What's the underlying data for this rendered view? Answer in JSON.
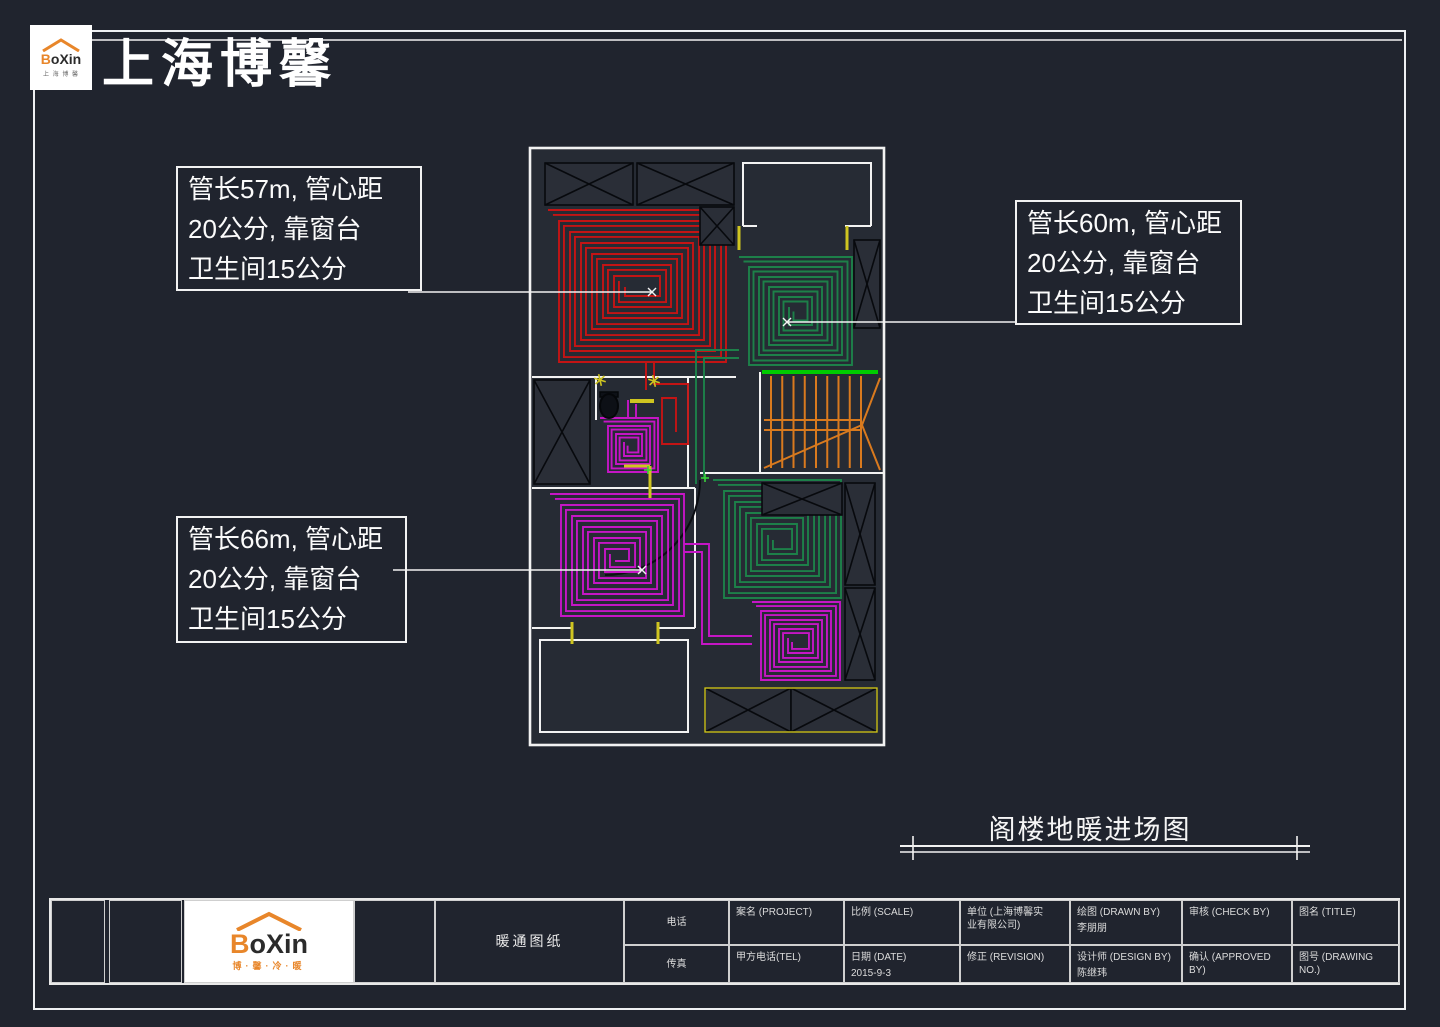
{
  "header": {
    "brand_title": "上海博馨",
    "logo_word": "Boxin",
    "logo_sub_top": "上 海 博 馨"
  },
  "annotations": [
    {
      "text": "管长57m, 管心距\n20公分, 靠窗台\n卫生间15公分"
    },
    {
      "text": "管长60m, 管心距\n20公分, 靠窗台\n卫生间15公分"
    },
    {
      "text": "管长66m, 管心距\n20公分, 靠窗台\n卫生间15公分"
    }
  ],
  "drawing_title": "阁楼地暖进场图",
  "title_block": {
    "category": "暖通图纸",
    "logo_word": "Boxin",
    "logo_sub": "博·馨·冷·暖",
    "phone_label": "电话",
    "fax_label": "传真",
    "project_label": "案名 (PROJECT)",
    "client_tel_label": "甲方电话(TEL)",
    "scale_label": "比例 (SCALE)",
    "date_label": "日期 (DATE)",
    "date_value": "2015-9-3",
    "company_label": "单位 (上海博馨实\n业有限公司)",
    "revision_label": "修正 (REVISION)",
    "drawn_by_label": "绘图 (DRAWN BY)",
    "drawn_by_value": "李朋朋",
    "designer_label": "设计师 (DESIGN BY)",
    "designer_value": "陈继玮",
    "check_label": "审核 (CHECK BY)",
    "approved_label": "确认 (APPROVED BY)",
    "title_label": "图名 (TITLE)",
    "drawing_no_label": "图号 (DRAWING NO.)"
  },
  "colors": {
    "red_pipe": "#c41414",
    "green_pipe": "#1d8049",
    "purple_pipe": "#c516c5",
    "orange_stairs": "#d97a1e",
    "stair_green": "#00cc00",
    "yellow": "#cfc520",
    "wall": "#f2f2f2",
    "plan_fill": "#262b34",
    "hatch_fill": "#2a2e37",
    "hatch_line": "#07090d"
  }
}
